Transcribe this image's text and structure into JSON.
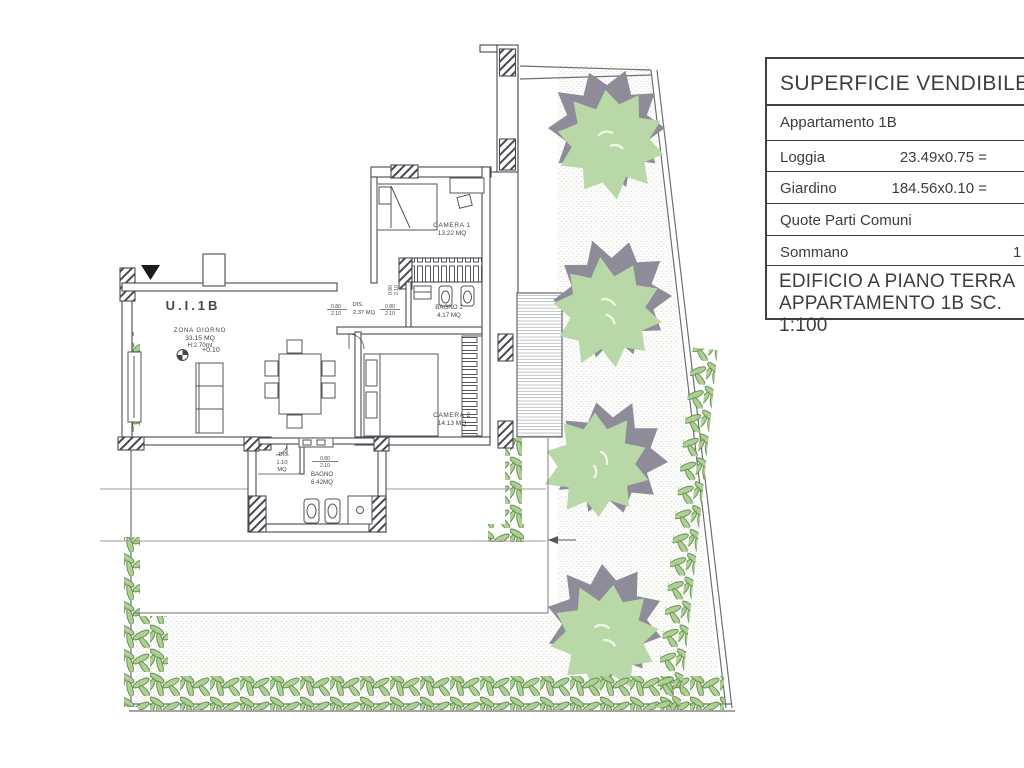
{
  "panel": {
    "header": "SUPERFICIE VENDIBILE",
    "rows": [
      {
        "label": "Appartamento 1B",
        "calc": "",
        "value": ""
      },
      {
        "label": "Loggia",
        "calc": "23.49x0.75 =",
        "value": ""
      },
      {
        "label": "Giardino",
        "calc": "184.56x0.10 =",
        "value": ""
      },
      {
        "label": "Quote Parti Comuni",
        "calc": "",
        "value": ""
      },
      {
        "label": "Sommano",
        "calc": "",
        "value": "1"
      }
    ],
    "title_line1": "EDIFICIO A PIANO TERRA",
    "title_line2": "APPARTAMENTO 1B SC. 1:100"
  },
  "plan": {
    "unit": "U.I.1B",
    "zona_giorno": {
      "name": "ZONA GIORNO",
      "area": "33.15 MQ",
      "height": "H:2.70mt",
      "level": "+0.10"
    },
    "camera1": {
      "name": "CAMERA 1",
      "area": "13.22 MQ"
    },
    "bagno1": {
      "name": "BAGNO 1",
      "area": "4.17 MQ"
    },
    "dis1": {
      "name": "DIS.",
      "area": "2.37 MQ"
    },
    "camera2": {
      "name": "CAMERA 2",
      "area": "14.13 MQ"
    },
    "dis2": {
      "name": "DIS.",
      "area_l1": "1.10",
      "area_l2": "MQ"
    },
    "bagno2": {
      "name": "BAGNO",
      "area": "6.42MQ"
    },
    "dims": {
      "d080": "0.80",
      "d090": "0.90",
      "d210": "2.10"
    }
  },
  "colors": {
    "line": "#4a4a52",
    "tree_green": "#b8d8a7",
    "tree_shadow": "#8d8c98",
    "hedge_fill": "#aecf95",
    "hedge_stroke": "#5e8a44",
    "stipple_dot": "#c4cbc3"
  }
}
